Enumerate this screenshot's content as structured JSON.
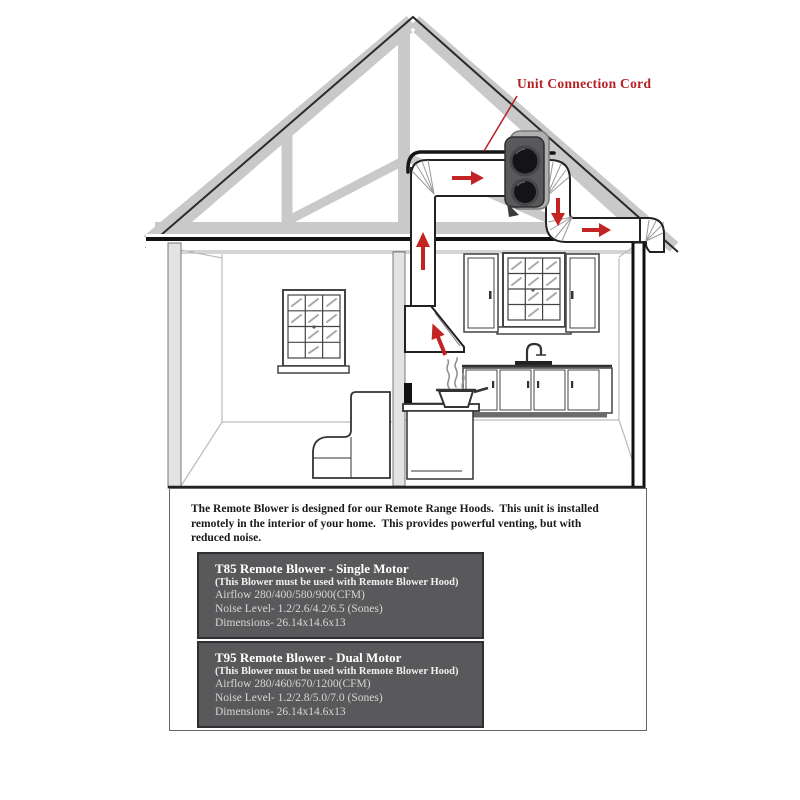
{
  "diagram": {
    "annotation_label": "Unit Connection Cord",
    "annotation_color": "#b52025",
    "airflow_arrows": [
      {
        "icon": "arrow-up-icon",
        "direction": "up",
        "location": "hood-duct-at-ceiling"
      },
      {
        "icon": "arrow-right-icon",
        "direction": "right",
        "location": "attic-duct-to-blower"
      },
      {
        "icon": "arrow-down-icon",
        "direction": "down",
        "location": "duct-after-blower"
      },
      {
        "icon": "arrow-right-icon",
        "direction": "right",
        "location": "exit-duct-at-eave"
      },
      {
        "icon": "arrow-up-left-icon",
        "direction": "up-left",
        "location": "range-hood-mouth"
      }
    ],
    "arrow_color": "#c42323",
    "scene_parts": [
      "roof-truss",
      "remote-blower-unit",
      "ductwork",
      "range-hood",
      "cooking-pot-with-steam",
      "kitchen-window",
      "living-room-window",
      "kitchen-cabinets",
      "sink-faucet",
      "sofa",
      "island-counter"
    ]
  },
  "description": {
    "lines": [
      "The Remote Blower is designed for our Remote Range Hoods.  This unit is installed",
      "remotely in the interior of your home.  This provides powerful venting, but with",
      "reduced noise."
    ]
  },
  "products": [
    {
      "title": "T85 Remote Blower - Single Motor",
      "note": "(This Blower must be used with Remote Blower Hood)",
      "airflow": "Airflow 280/400/580/900(CFM)",
      "noise": "Noise Level- 1.2/2.6/4.2/6.5 (Sones)",
      "dimensions": "Dimensions- 26.14x14.6x13"
    },
    {
      "title": "T95 Remote Blower - Dual Motor",
      "note": "(This Blower must be used with Remote Blower Hood)",
      "airflow": "Airflow 280/460/670/1200(CFM)",
      "noise": "Noise Level- 1.2/2.8/5.0/7.0 (Sones)",
      "dimensions": "Dimensions- 26.14x14.6x13"
    }
  ],
  "colors": {
    "accent_red": "#b52025",
    "arrow_red": "#c42323",
    "truss_gray": "#c9c9c9",
    "product_box_bg": "#59595b",
    "product_box_text": "#d6d6d6"
  }
}
